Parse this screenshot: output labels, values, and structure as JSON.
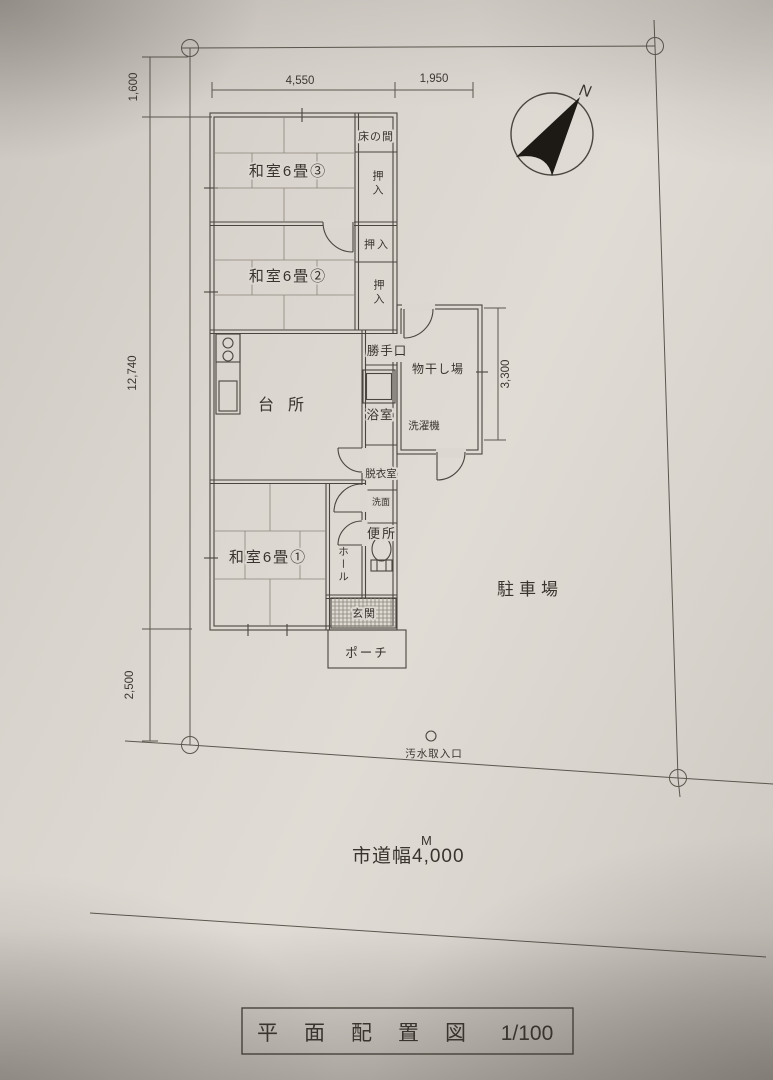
{
  "colors": {
    "paper": "#dcd7d0",
    "ink": "#45413b"
  },
  "compass": {
    "north_label": "N"
  },
  "dimensions": {
    "top_offset": "1,600",
    "house_width": "4,550",
    "right_width": "1,950",
    "house_depth": "12,740",
    "bottom_offset": "2,500",
    "extension_depth": "3,300"
  },
  "rooms": {
    "tokonoma": "床の間",
    "closet": "押入",
    "washitsu3": "和室6畳③",
    "washitsu2": "和室6畳②",
    "washitsu1": "和室6畳①",
    "kitchen": "台所",
    "back_door": "勝手口",
    "drying_area": "物干し場",
    "bath": "浴室",
    "washing_machine": "洗濯機",
    "dressing_room": "脱衣室",
    "washstand": "洗面",
    "toilet": "便所",
    "hall": "ホール",
    "entrance": "玄関",
    "porch": "ポーチ"
  },
  "site": {
    "parking": "駐車場",
    "sewage_inlet": "汚水取入口",
    "road_width": "市道幅4,000",
    "road_width_unit": "M"
  },
  "title_block": {
    "title": "平面配置図",
    "scale": "1/100"
  }
}
